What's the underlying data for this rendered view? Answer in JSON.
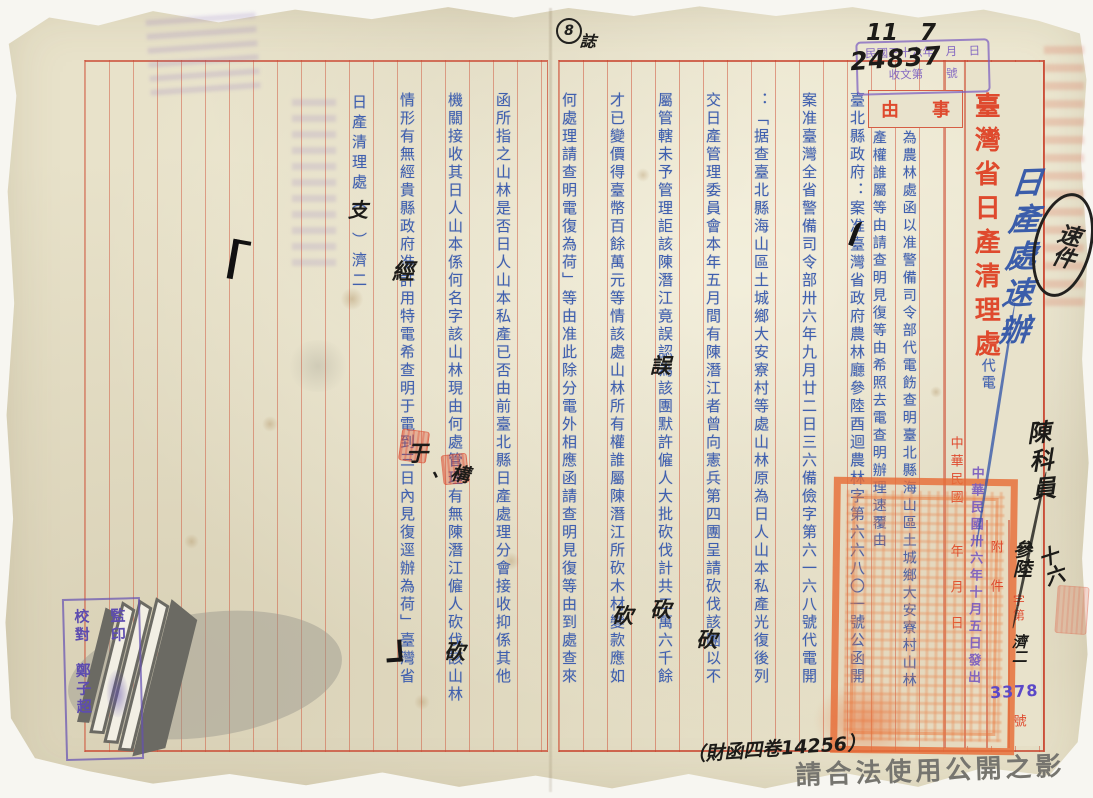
{
  "header": {
    "title": "臺灣省日產清理處",
    "doc_type": "代電",
    "subject_label_right": "事",
    "subject_label_left": "由",
    "subject_col1": "為農林處函以准警備司令部代電飭查明臺北縣海山區土城鄉大安寮村山林",
    "subject_col2": "產權誰屬等由請查明見復等由希照去電查明辦理速覆由"
  },
  "body": {
    "right_page": [
      "臺北縣政府：案准臺灣省政府農林廳參陸酉迴農林字第六六八〇一號公函開",
      "案准臺灣全省警備司令部卅六年九月廿二日三六備儉字第六一六八號代電開",
      "：「据查臺北縣海山區土城鄉大安寮村等處山林原為日人山本私產光復後列",
      "交日產管理委員會本年五月間有陳潛江者曾向憲兵第四團呈請砍伐該團以不",
      "屬管轄未予管理詎該陳潛江竟誤認為該團默許僱人大批砍伐計共二萬六千餘",
      "才已變價得臺幣百餘萬元等情該處山林所有權誰屬陳潛江所砍木材變款應如",
      "何處理請查明電復為荷」等由准此除分電外相應函請查明見復等由到處查來"
    ],
    "left_page": [
      "函所指之山林是否日人山本私產已否由前臺北縣日產處理分會接收抑係其他",
      "機關接收其日人山本係何名字該山林現由何處管理有無陳潛江僱人砍伐該山林",
      "情形有無經貴縣政府准許用特電希查明于電到三日內見復逕辦為荷」臺灣省"
    ],
    "signature_pre": "日產清理處（",
    "signature_post": "）濟二"
  },
  "form": {
    "date_line": "中華民國　　年　月　日",
    "attachment_label": "附件",
    "zi_di": "字第",
    "hao": "號"
  },
  "stamps": {
    "receipt_line1": "民國三十六年　月　日",
    "receipt_line2": "收文第　　號",
    "receipt_month_hw": "11",
    "receipt_day_hw": "7",
    "receipt_number_hw": "24837",
    "dispatch_date_stamp": "中華民國卅六年十月五日發出",
    "file_number_stamp": "3378",
    "series_hw": "參陸",
    "ji_hw": "濟二",
    "verify_right": "監印",
    "verify_left": "校對　鄭子超"
  },
  "annotations": {
    "top_note_number": "8",
    "top_note_char": "誌",
    "blue_note": "日產處速辦",
    "circled_note": "速件",
    "margin_note": "陳科員",
    "margin_note_2": "十六",
    "corr_kan_1": "砍",
    "corr_wu": "誤",
    "corr_kan_2": "砍",
    "corr_kan_3": "砍",
    "corr_kan_4": "砍",
    "corr_jing": "經",
    "corr_yu": "于",
    "corr_gou": "、構",
    "corr_zhi": "支",
    "archive_code": "（財函四卷14256）"
  },
  "footer": {
    "usage_watermark": "請合法使用公開之影像"
  },
  "colors": {
    "typed_blue": "#3f5fae",
    "print_red": "#df4a2e",
    "stamp_purple": "#7a5cc0",
    "seal_orange": "#e76e38"
  }
}
